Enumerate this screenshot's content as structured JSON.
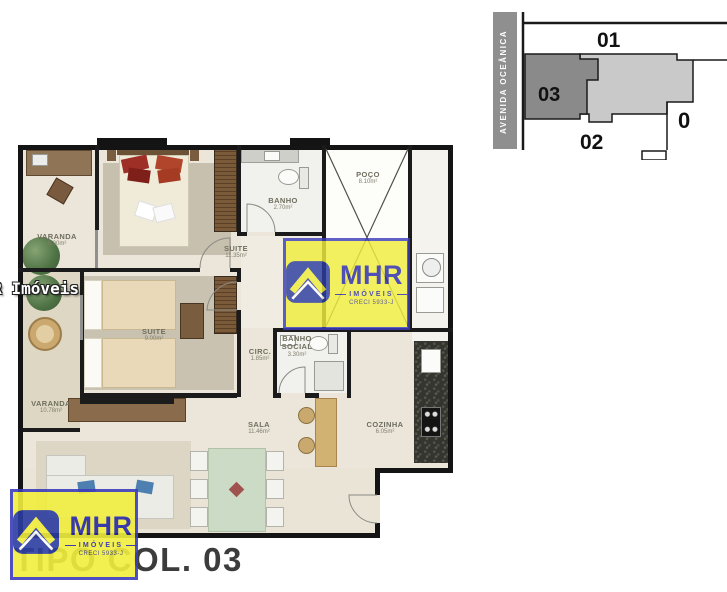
{
  "site_plan": {
    "avenue_label": "AVENIDA OCEÂNICA",
    "units": [
      {
        "id": "01"
      },
      {
        "id": "03"
      },
      {
        "id": "02"
      },
      {
        "id": "0"
      }
    ],
    "colors": {
      "highlight_unit": "#8a8a8a",
      "neighbor_unit": "#c9c9c9",
      "avenue_bar": "#8f8f8f"
    }
  },
  "floor_plan": {
    "rooms": [
      {
        "name": "VARANDA",
        "area": "6.00m²"
      },
      {
        "name": "SUITE",
        "area": "11.35m²"
      },
      {
        "name": "BANHO",
        "area": "2.70m²"
      },
      {
        "name": "POÇO",
        "area": "8.10m²"
      },
      {
        "name": "SUITE",
        "area": "9.00m²"
      },
      {
        "name": "CIRC.",
        "area": "1.85m²"
      },
      {
        "name": "BANHO SOCIAL",
        "area": "3.30m²"
      },
      {
        "name": "SALA",
        "area": "11.46m²"
      },
      {
        "name": "COZINHA",
        "area": "6.05m²"
      },
      {
        "name": "VARANDA",
        "area": "10.78m²"
      }
    ]
  },
  "branding": {
    "logo_text": "MHR",
    "logo_subtext": "IMÓVEIS",
    "logo_creci": "CRECI 5933-J",
    "edge_watermark": "MHR Imóveis",
    "caption": "TIPO COL. 03",
    "colors": {
      "logo_yellow": "#f1ee3e",
      "logo_blue": "#2929a8"
    }
  }
}
